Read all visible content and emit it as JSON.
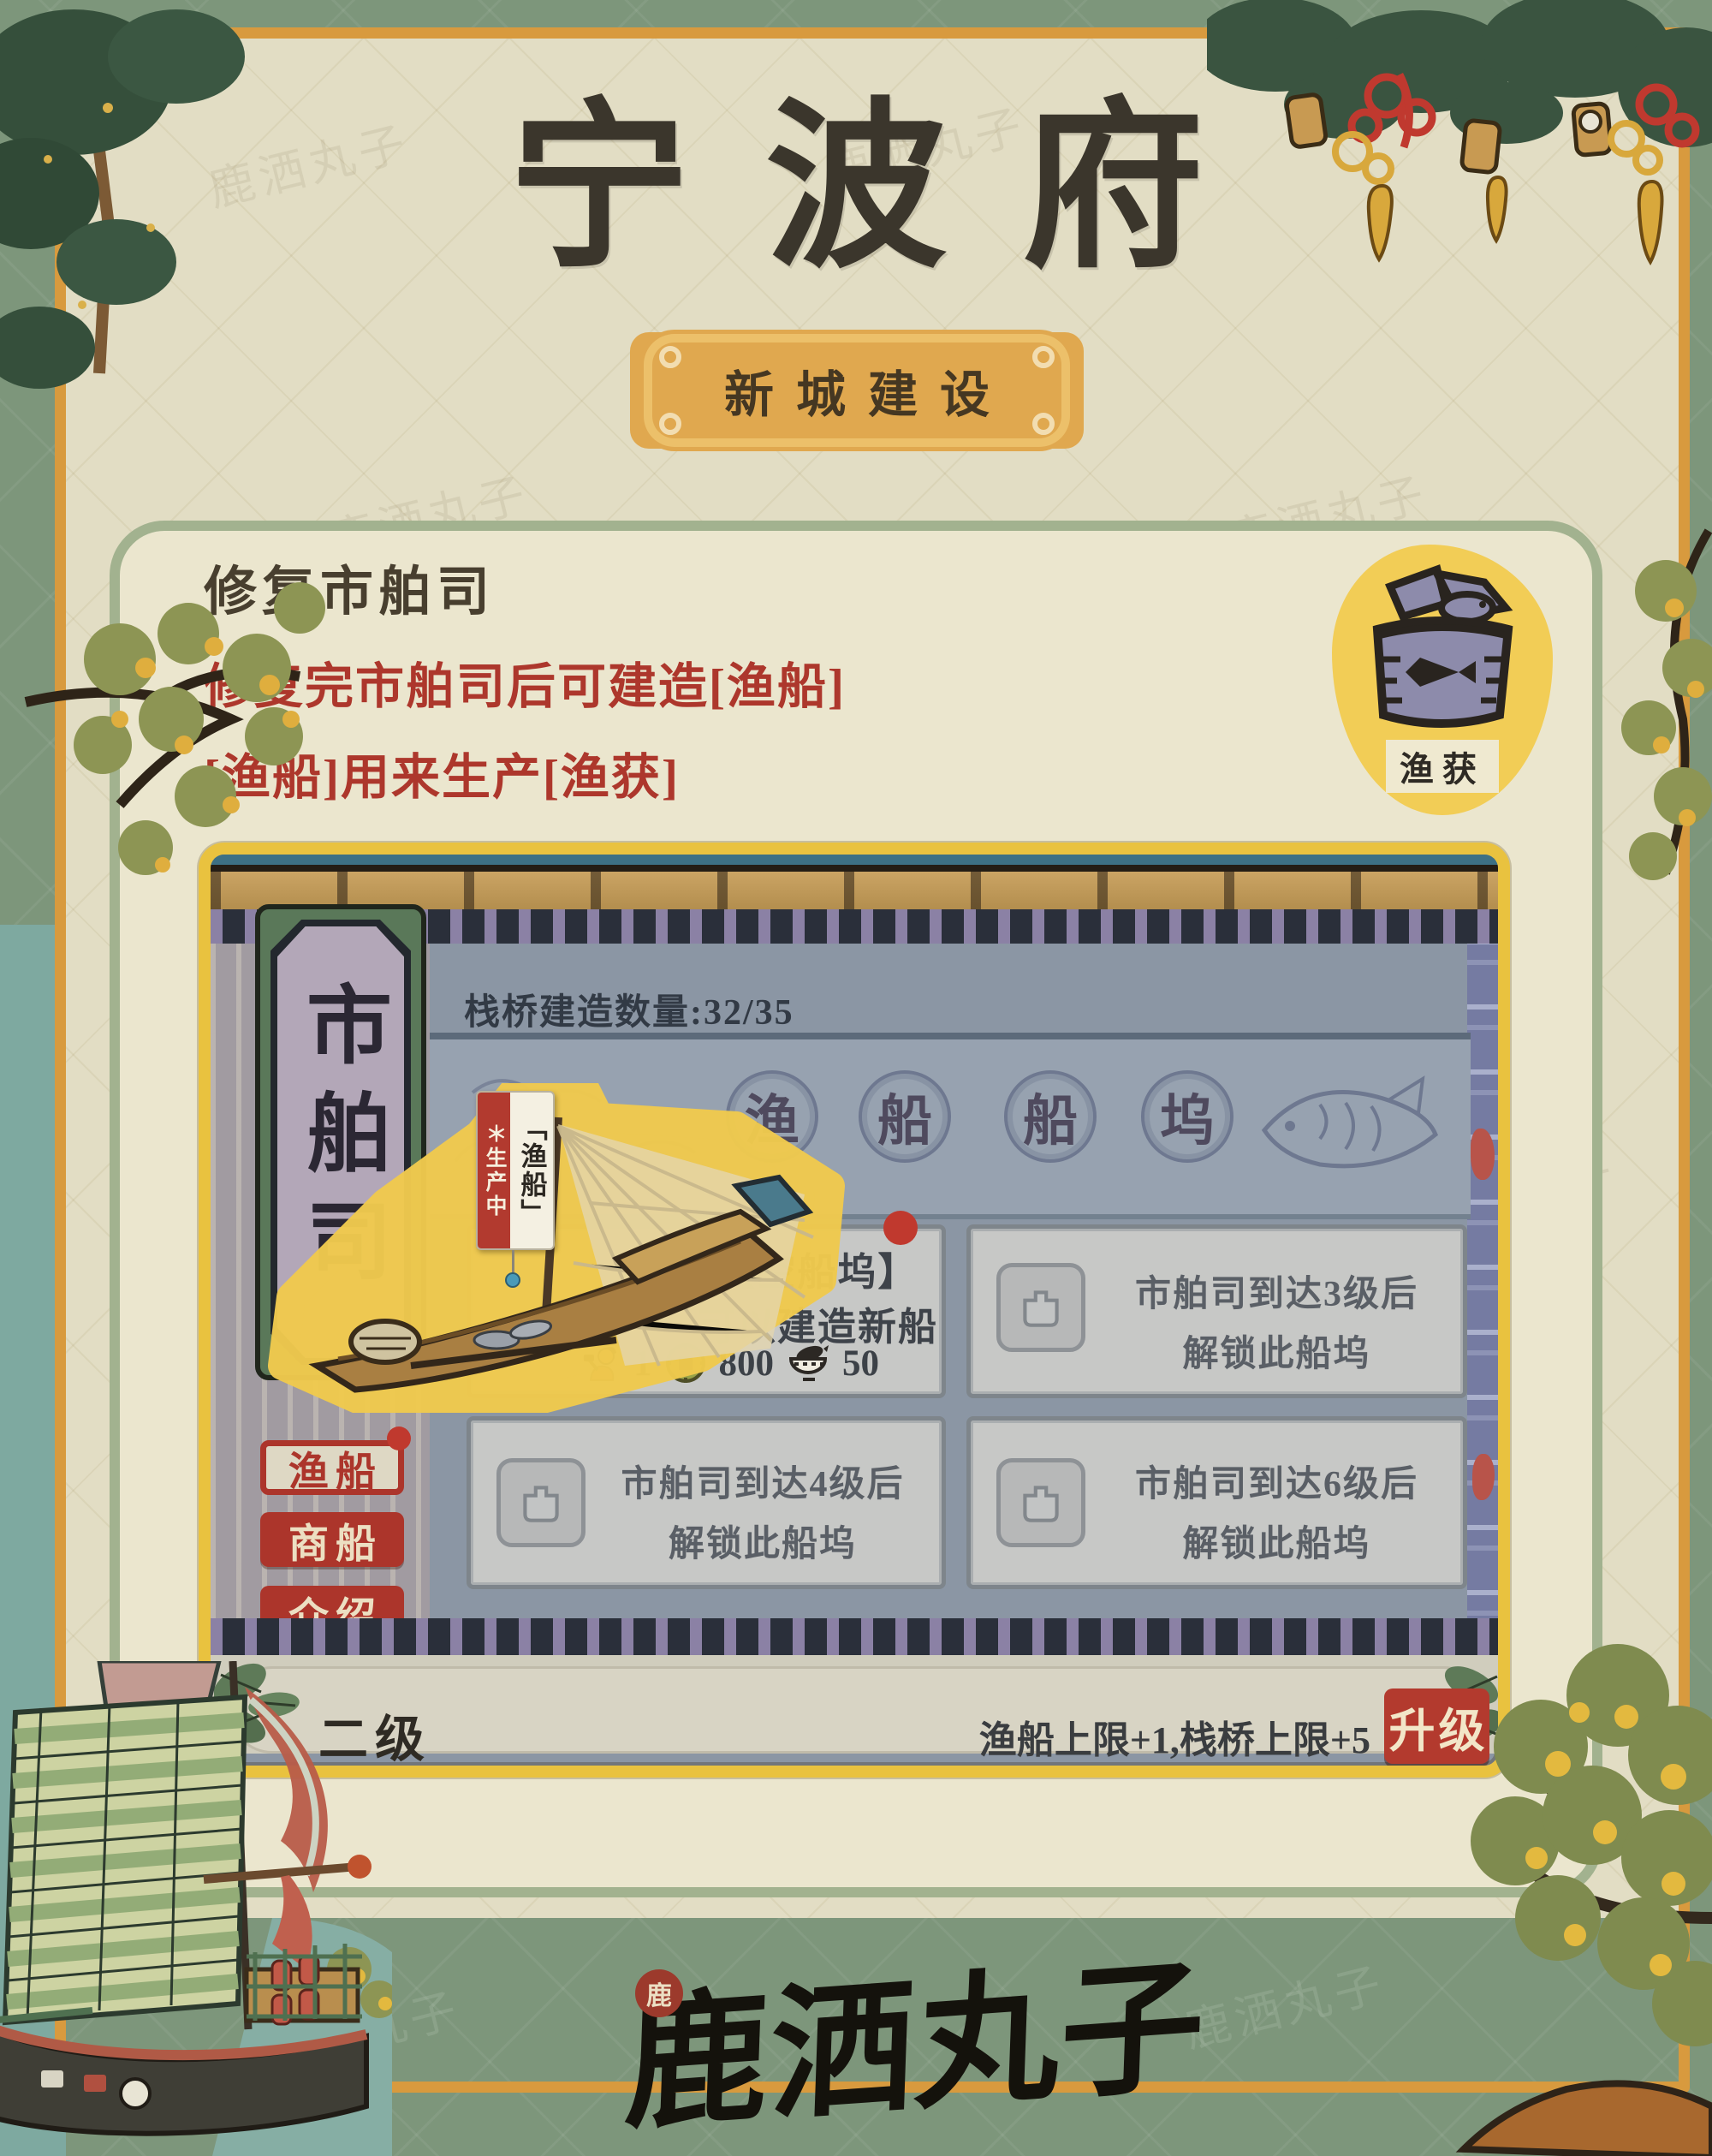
{
  "page": {
    "title": "宁波府",
    "banner": "新城建设",
    "signature": "鹿洒丸子",
    "seal": "鹿"
  },
  "guide": {
    "heading": "修复市舶司",
    "line1": "修复完市舶司后可建造[渔船]",
    "line2": "[渔船]用来生产[渔获]",
    "badge_label": "渔获"
  },
  "game": {
    "sign_vertical": "市舶司",
    "pier_counter": "栈桥建造数量:32/35",
    "dock_title_chars": [
      "渔",
      "船",
      "船",
      "坞"
    ],
    "boat_tag": {
      "status": "生产中",
      "name": "「渔船」"
    },
    "tabs": [
      {
        "label": "渔船",
        "active": true
      },
      {
        "label": "商船",
        "active": false
      },
      {
        "label": "介绍",
        "active": false
      }
    ],
    "empty_slot": {
      "title": "【空船坞】",
      "desc": "可以建造新船",
      "costs": [
        {
          "icon": "worker-icon",
          "value": "1"
        },
        {
          "icon": "coin-icon",
          "value": "800"
        },
        {
          "icon": "food-bowl-icon",
          "value": "50"
        }
      ]
    },
    "locked_slots": [
      {
        "line1": "市舶司到达3级后",
        "line2": "解锁此船坞"
      },
      {
        "line1": "市舶司到达4级后",
        "line2": "解锁此船坞"
      },
      {
        "line1": "市舶司到达6级后",
        "line2": "解锁此船坞"
      }
    ],
    "level": "二级",
    "upgrade_effect": "渔船上限+1,栈桥上限+5",
    "upgrade_label": "升级"
  },
  "footer": {
    "logo_text": "零六找游戏",
    "url1": "www.lingliuyx.com",
    "url2": "www.06zyx.com"
  },
  "watermark_text": "鹿洒丸子",
  "colors": {
    "accent_red": "#b23a2f",
    "frame_gold": "#e9c23f",
    "banner_gold": "#e0a84f",
    "paper": "#e2ddc4",
    "sage_green": "#7d967b",
    "ui_bluegrey": "#8b96a4"
  }
}
